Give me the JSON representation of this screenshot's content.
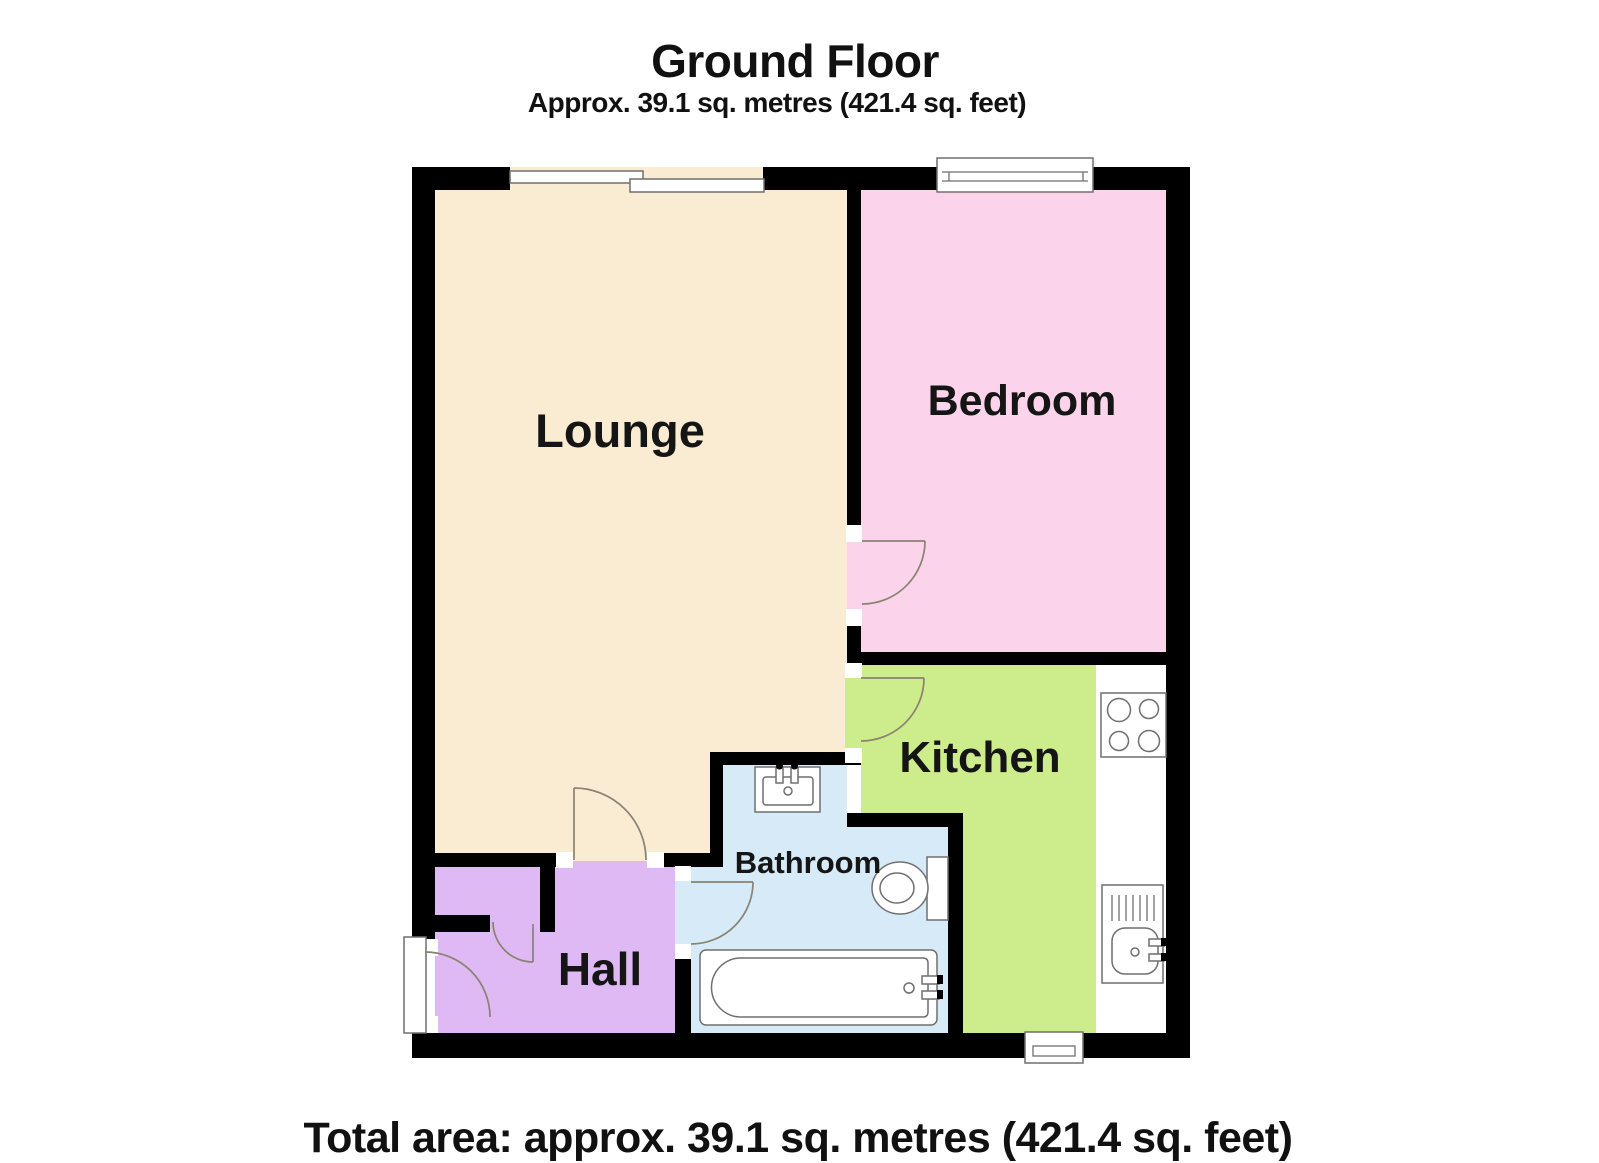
{
  "header": {
    "title": "Ground Floor",
    "subtitle": "Approx. 39.1 sq. metres (421.4 sq. feet)"
  },
  "footer": {
    "total_area": "Total area: approx. 39.1 sq. metres (421.4 sq. feet)"
  },
  "rooms": {
    "lounge": {
      "label": "Lounge",
      "color": "#faecd3"
    },
    "bedroom": {
      "label": "Bedroom",
      "color": "#fbd4eb"
    },
    "kitchen": {
      "label": "Kitchen",
      "color": "#cdec8b"
    },
    "bathroom": {
      "label": "Bathroom",
      "color": "#d6eaf8"
    },
    "hall": {
      "label": "Hall",
      "color": "#dfb9f3"
    }
  },
  "fixtures": {
    "bath": "bath-tub",
    "toilet": "toilet",
    "basin": "wash-basin",
    "kitchen_sink": "kitchen-sink-drainer",
    "hob": "four-ring-hob",
    "counter": "kitchen-worktop"
  },
  "colors": {
    "wall": "#000000",
    "fixture_stroke": "#6f6f6f",
    "door_arc": "#8a8272",
    "counter": "#ffffff",
    "background": "#ffffff"
  }
}
